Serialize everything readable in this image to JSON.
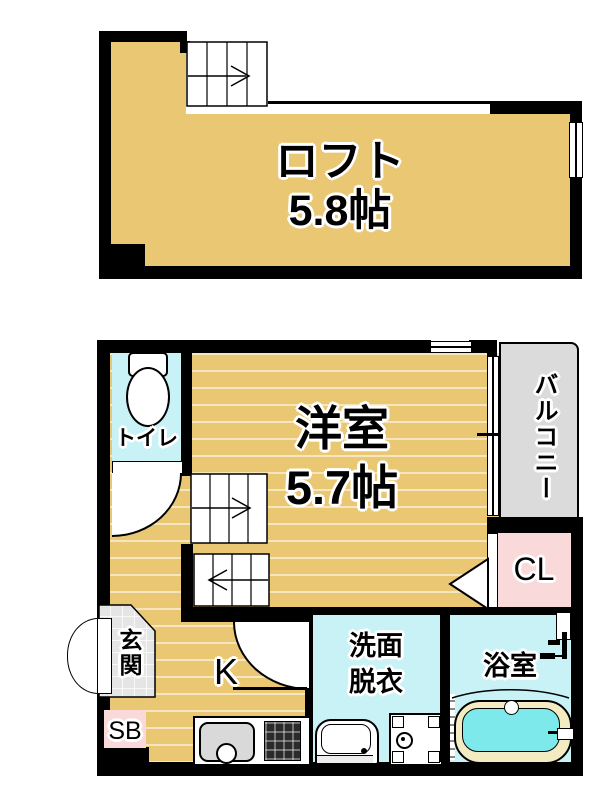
{
  "loft": {
    "name": "ロフト",
    "area": "5.8帖"
  },
  "first_floor": {
    "room_name": "洋室",
    "room_area": "5.7帖",
    "toilet": "トイレ",
    "balcony": "バルコニー",
    "closet": "CL",
    "entrance": "玄関",
    "kitchen": "K",
    "shoe_box": "SB",
    "washroom_line1": "洗面",
    "washroom_line2": "脱衣",
    "bathroom": "浴室"
  },
  "colors": {
    "floor_tan": "#EAC773",
    "wet_room_cyan": "#C9F2F6",
    "balcony_gray": "#DBDBDB",
    "closet_pink": "#FAD9DB",
    "tub_water": "#7DE9EA",
    "entrance_tile": "#E5E5E5",
    "wall_black": "#000000"
  }
}
